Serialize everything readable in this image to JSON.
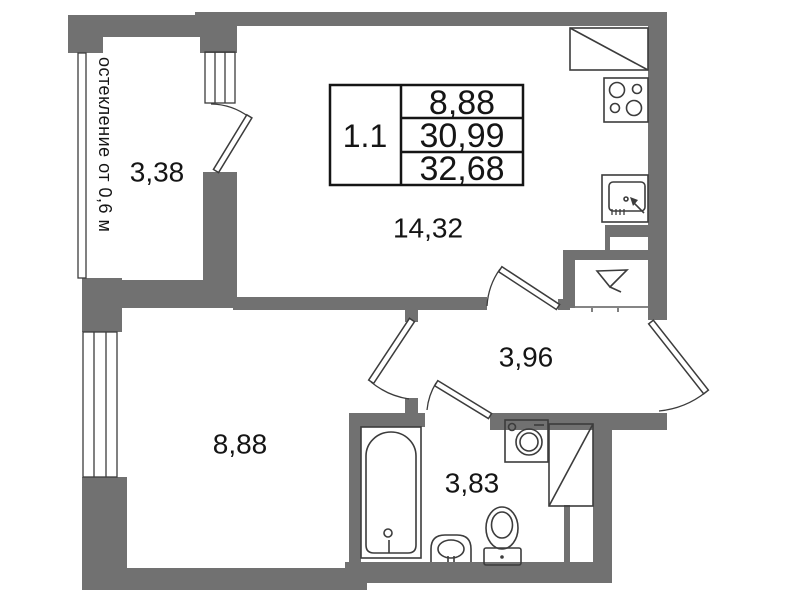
{
  "plan": {
    "unit": {
      "id": "1.1",
      "areas": [
        "8,88",
        "30,99",
        "32,68"
      ]
    },
    "rooms": [
      {
        "id": "balcony",
        "area": "3,38"
      },
      {
        "id": "living-kitchen",
        "area": "14,32"
      },
      {
        "id": "bedroom",
        "area": "8,88"
      },
      {
        "id": "hallway",
        "area": "3,96"
      },
      {
        "id": "bathroom",
        "area": "3,83"
      }
    ],
    "glazing_note": "остекление от 0,6 м",
    "fixtures": [
      "fridge",
      "stove",
      "kitchen-sink",
      "ventilation-shaft",
      "bathtub",
      "washing-machine",
      "cabinet",
      "washbasin",
      "toilet"
    ],
    "colors": {
      "wall": "#717171",
      "line": "#3c3c3c",
      "text": "#151515",
      "background": "#ffffff"
    }
  }
}
